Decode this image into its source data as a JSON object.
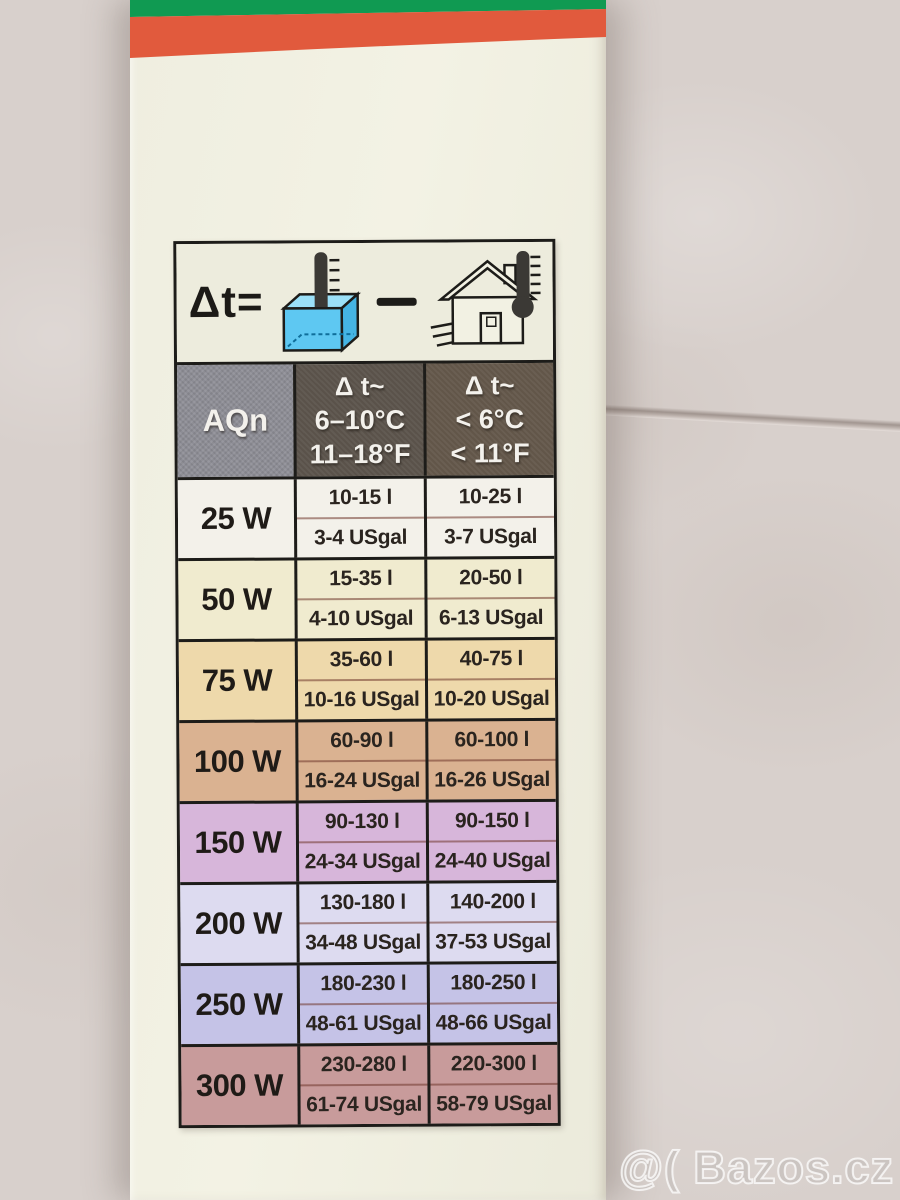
{
  "watermark": {
    "text": "@( Bazos.cz"
  },
  "package": {
    "stripe_green": "#109a52",
    "stripe_red": "#e15a3d",
    "box_color": "#f0efe1"
  },
  "formula": {
    "delta_label": "Δt=",
    "minus_icon": "minus-icon",
    "left_icon": "aquarium-thermometer-icon",
    "right_icon": "house-thermometer-icon"
  },
  "header": {
    "aqn": "AQn",
    "col_mild": {
      "l1": "Δ t~",
      "l2": "6–10°C",
      "l3": "11–18°F"
    },
    "col_cold": {
      "l1": "Δ t~",
      "l2": "< 6°C",
      "l3": "< 11°F"
    }
  },
  "rows": [
    {
      "watt": "25 W",
      "mild_l": "10-15 l",
      "mild_gal": "3-4 USgal",
      "cold_l": "10-25 l",
      "cold_gal": "3-7 USgal",
      "bg": "#f3f1ea"
    },
    {
      "watt": "50 W",
      "mild_l": "15-35 l",
      "mild_gal": "4-10 USgal",
      "cold_l": "20-50 l",
      "cold_gal": "6-13 USgal",
      "bg": "#f0ebcf"
    },
    {
      "watt": "75 W",
      "mild_l": "35-60 l",
      "mild_gal": "10-16 USgal",
      "cold_l": "40-75 l",
      "cold_gal": "10-20 USgal",
      "bg": "#eed9ab"
    },
    {
      "watt": "100 W",
      "mild_l": "60-90 l",
      "mild_gal": "16-24 USgal",
      "cold_l": "60-100 l",
      "cold_gal": "16-26 USgal",
      "bg": "#dab291"
    },
    {
      "watt": "150 W",
      "mild_l": "90-130 l",
      "mild_gal": "24-34 USgal",
      "cold_l": "90-150 l",
      "cold_gal": "24-40 USgal",
      "bg": "#d7b6da"
    },
    {
      "watt": "200 W",
      "mild_l": "130-180 l",
      "mild_gal": "34-48 USgal",
      "cold_l": "140-200 l",
      "cold_gal": "37-53 USgal",
      "bg": "#dddbf0"
    },
    {
      "watt": "250 W",
      "mild_l": "180-230 l",
      "mild_gal": "48-61 USgal",
      "cold_l": "180-250 l",
      "cold_gal": "48-66 USgal",
      "bg": "#c5c3e7"
    },
    {
      "watt": "300 W",
      "mild_l": "230-280 l",
      "mild_gal": "61-74 USgal",
      "cold_l": "220-300 l",
      "cold_gal": "58-79 USgal",
      "bg": "#c89b9b"
    }
  ]
}
